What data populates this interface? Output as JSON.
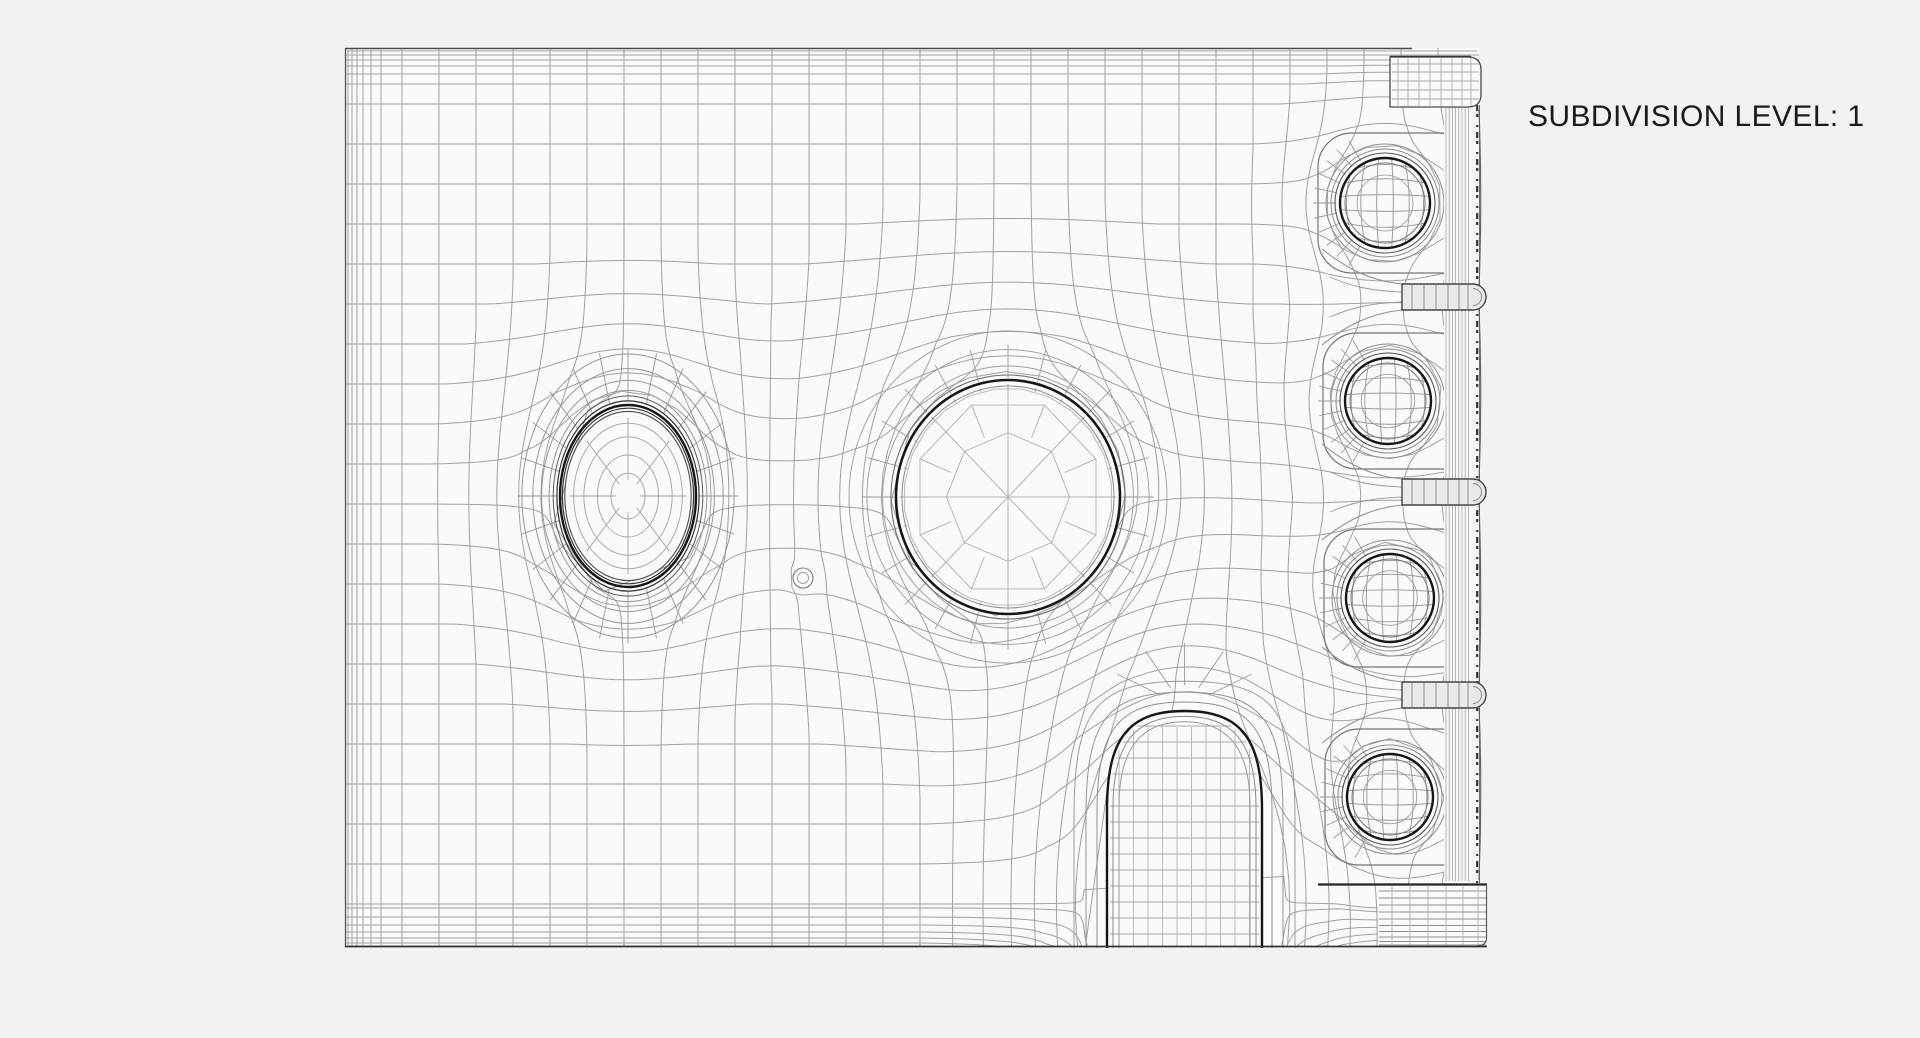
{
  "label": {
    "text": "SUBDIVISION LEVEL: 1"
  },
  "colors": {
    "background": "#f2f2f2",
    "surface": "#fafafa",
    "grid_line": "#919191",
    "detail_line": "#9a9a9a",
    "faint_line": "#b3b3b3",
    "mid_line": "#757575",
    "rim_dark": "#161616",
    "rim_mid": "#3f3f3f",
    "edge": "#555555",
    "tab_fill": "#e9e9e9",
    "wall_fill": "#f7f7f7",
    "text": "#1a1a1a"
  },
  "scene": {
    "plate": {
      "left": 345,
      "top": 48,
      "right": 1479,
      "bottom": 947
    },
    "oval_boss": {
      "cx": 628,
      "cy": 496,
      "rx": 68,
      "ry": 91
    },
    "center_hole": {
      "cx": 1008,
      "cy": 497,
      "rx": 112,
      "ry": 117
    },
    "dimple": {
      "cx": 803,
      "cy": 578,
      "r": 10
    },
    "arch": {
      "x1": 1107,
      "x2": 1262,
      "apex": 711,
      "bottom": 947
    },
    "side_holes": [
      {
        "cx": 1385,
        "cy": 203,
        "r": 45
      },
      {
        "cx": 1388,
        "cy": 401,
        "r": 43
      },
      {
        "cx": 1390,
        "cy": 598,
        "r": 44
      },
      {
        "cx": 1390,
        "cy": 797,
        "r": 43
      }
    ],
    "tabs_y": [
      297,
      492,
      695
    ],
    "wall": {
      "left": 1444,
      "right": 1479,
      "top": 105,
      "bottom": 883
    },
    "flange": {
      "left": 1390,
      "top": 57,
      "right": 1481,
      "bottom": 107
    },
    "corner_block": {
      "left": 1378,
      "top": 885,
      "right": 1487,
      "bottom": 947
    }
  }
}
